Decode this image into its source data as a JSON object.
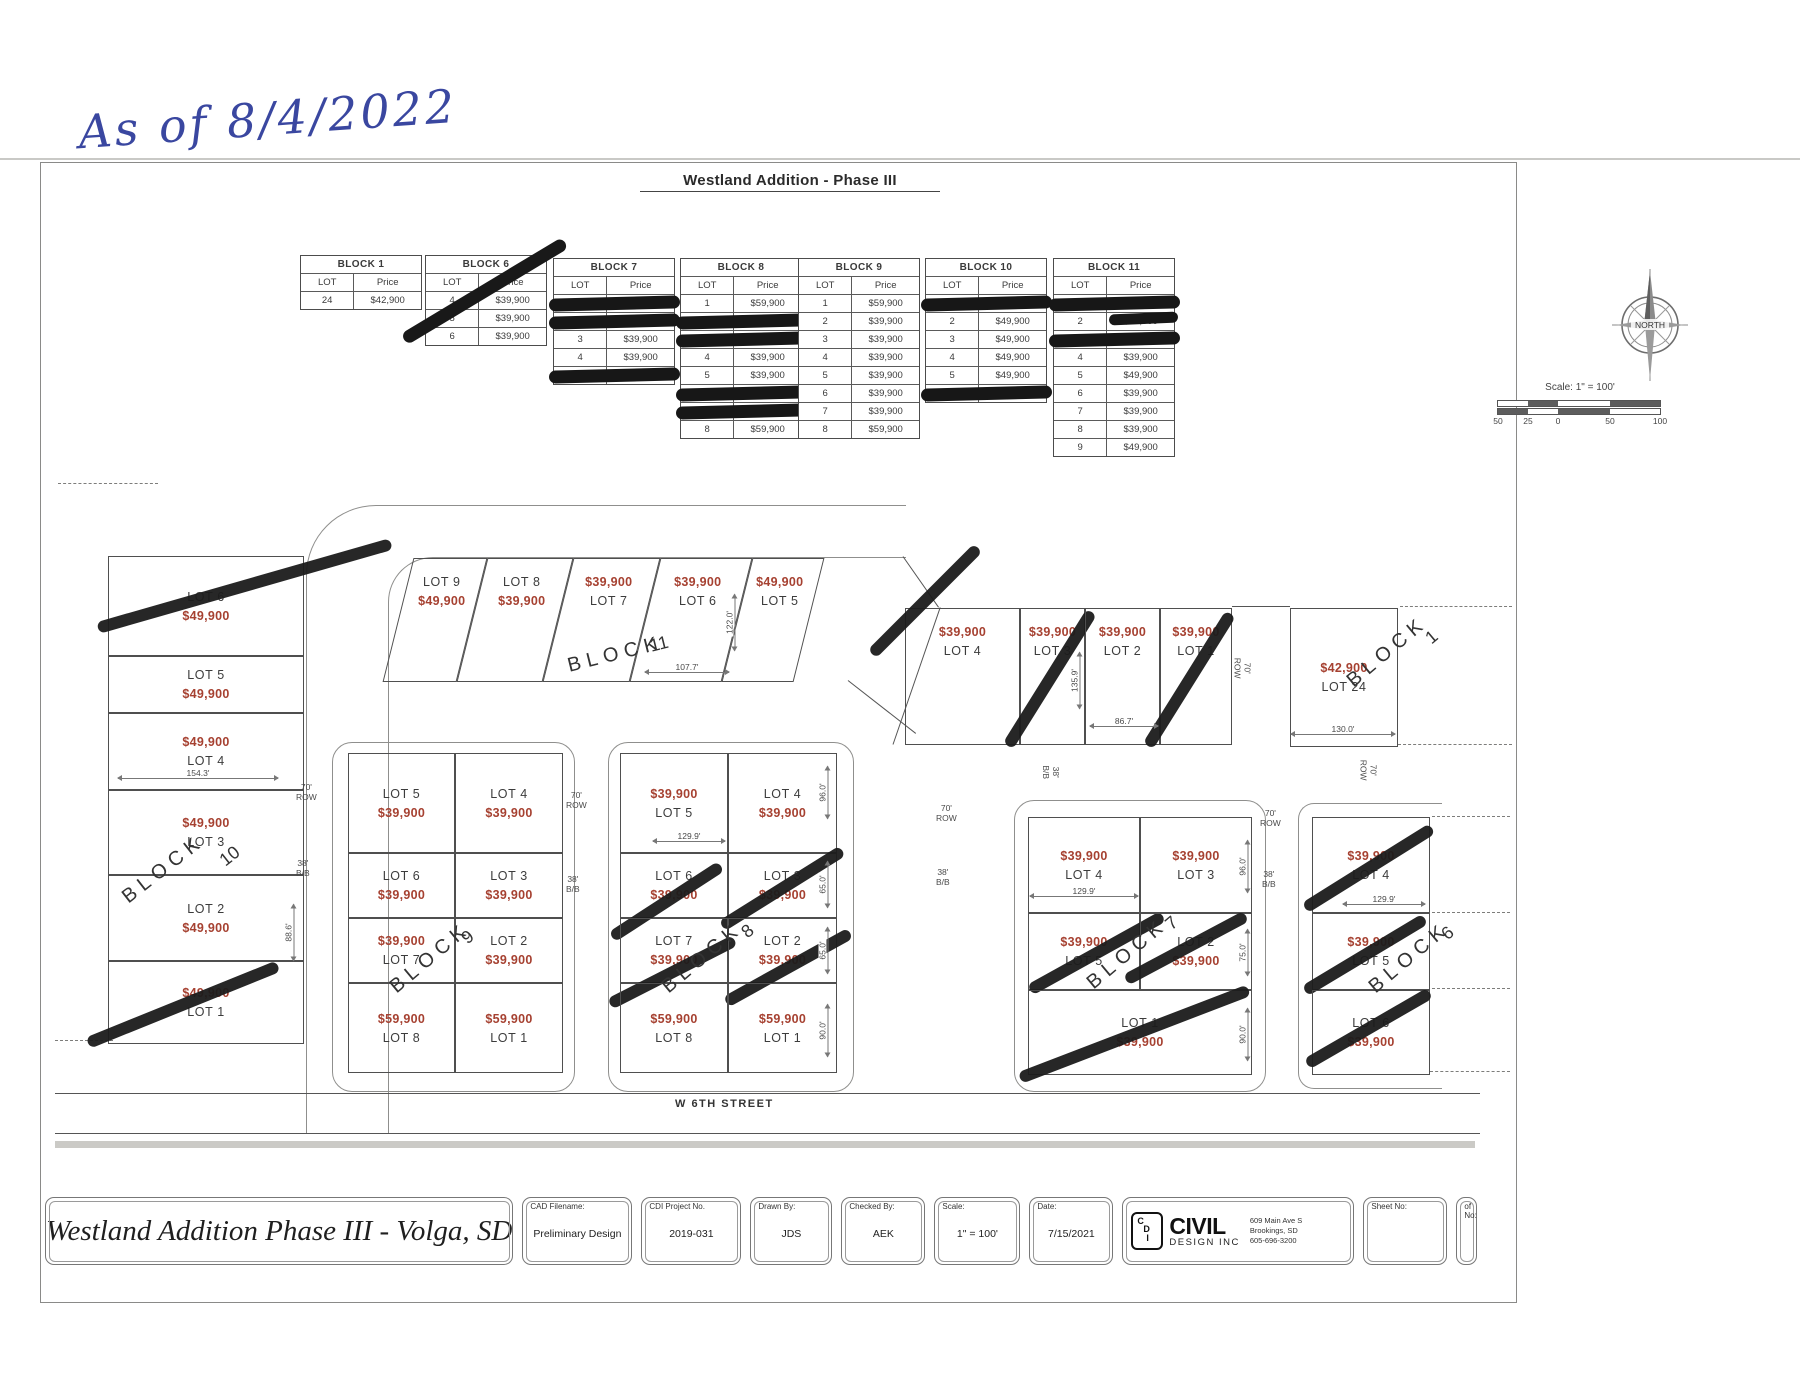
{
  "note": "As of 8/4/2022",
  "sheet_title": "Westland Addition - Phase III",
  "tables": [
    {
      "title": "BLOCK 1",
      "lot_header": "LOT",
      "price_header": "Price",
      "strike": false,
      "rows": [
        {
          "lot": "24",
          "price": "$42,900",
          "redacted": false
        }
      ]
    },
    {
      "title": "BLOCK 6",
      "lot_header": "LOT",
      "price_header": "Price",
      "strike": true,
      "rows": [
        {
          "lot": "4",
          "price": "$39,900",
          "redacted": false
        },
        {
          "lot": "5",
          "price": "$39,900",
          "redacted": false
        },
        {
          "lot": "6",
          "price": "$39,900",
          "redacted": false
        }
      ]
    },
    {
      "title": "BLOCK 7",
      "lot_header": "LOT",
      "price_header": "Price",
      "strike": false,
      "rows": [
        {
          "lot": "1",
          "price": "",
          "redacted": true
        },
        {
          "lot": "2",
          "price": "",
          "redacted": true
        },
        {
          "lot": "3",
          "price": "$39,900",
          "redacted": false
        },
        {
          "lot": "4",
          "price": "$39,900",
          "redacted": false
        },
        {
          "lot": "5",
          "price": "",
          "redacted": true
        }
      ]
    },
    {
      "title": "BLOCK 8",
      "lot_header": "LOT",
      "price_header": "Price",
      "strike": false,
      "rows": [
        {
          "lot": "1",
          "price": "$59,900",
          "redacted": false
        },
        {
          "lot": "2",
          "price": "",
          "redacted": true
        },
        {
          "lot": "3",
          "price": "",
          "redacted": true
        },
        {
          "lot": "4",
          "price": "$39,900",
          "redacted": false
        },
        {
          "lot": "5",
          "price": "$39,900",
          "redacted": false
        },
        {
          "lot": "6",
          "price": "",
          "redacted": true
        },
        {
          "lot": "7",
          "price": "",
          "redacted": true
        },
        {
          "lot": "8",
          "price": "$59,900",
          "redacted": false
        }
      ]
    },
    {
      "title": "BLOCK 9",
      "lot_header": "LOT",
      "price_header": "Price",
      "strike": false,
      "rows": [
        {
          "lot": "1",
          "price": "$59,900",
          "redacted": false
        },
        {
          "lot": "2",
          "price": "$39,900",
          "redacted": false
        },
        {
          "lot": "3",
          "price": "$39,900",
          "redacted": false
        },
        {
          "lot": "4",
          "price": "$39,900",
          "redacted": false
        },
        {
          "lot": "5",
          "price": "$39,900",
          "redacted": false
        },
        {
          "lot": "6",
          "price": "$39,900",
          "redacted": false
        },
        {
          "lot": "7",
          "price": "$39,900",
          "redacted": false
        },
        {
          "lot": "8",
          "price": "$59,900",
          "redacted": false
        }
      ]
    },
    {
      "title": "BLOCK 10",
      "lot_header": "LOT",
      "price_header": "Price",
      "strike": false,
      "rows": [
        {
          "lot": "1",
          "price": "",
          "redacted": true
        },
        {
          "lot": "2",
          "price": "$49,900",
          "redacted": false
        },
        {
          "lot": "3",
          "price": "$49,900",
          "redacted": false
        },
        {
          "lot": "4",
          "price": "$49,900",
          "redacted": false
        },
        {
          "lot": "5",
          "price": "$49,900",
          "redacted": false
        },
        {
          "lot": "6",
          "price": "",
          "redacted": true
        }
      ]
    },
    {
      "title": "BLOCK 11",
      "lot_header": "LOT",
      "price_header": "Price",
      "strike": false,
      "rows": [
        {
          "lot": "1",
          "price": "",
          "redacted": true
        },
        {
          "lot": "2",
          "price": "$39,900",
          "redacted": false,
          "partial": true
        },
        {
          "lot": "3",
          "price": "",
          "redacted": true
        },
        {
          "lot": "4",
          "price": "$39,900",
          "redacted": false
        },
        {
          "lot": "5",
          "price": "$49,900",
          "redacted": false
        },
        {
          "lot": "6",
          "price": "$39,900",
          "redacted": false
        },
        {
          "lot": "7",
          "price": "$39,900",
          "redacted": false
        },
        {
          "lot": "8",
          "price": "$39,900",
          "redacted": false
        },
        {
          "lot": "9",
          "price": "$49,900",
          "redacted": false
        }
      ]
    }
  ],
  "compass": {
    "label": "NORTH"
  },
  "scalebar": {
    "label": "Scale: 1\" = 100'",
    "ticks": [
      "50",
      "25",
      "0",
      "50",
      "100"
    ]
  },
  "map": {
    "street_label": "W 6TH STREET",
    "lots": [
      {
        "id": "b10-6",
        "label": "LOT 6",
        "price": "$49,900",
        "price_first": false,
        "crossed": true
      },
      {
        "id": "b10-5",
        "label": "LOT 5",
        "price": "$49,900",
        "price_first": false,
        "crossed": false
      },
      {
        "id": "b10-4",
        "label": "LOT 4",
        "price": "$49,900",
        "price_first": true,
        "crossed": false
      },
      {
        "id": "b10-3",
        "label": "LOT 3",
        "price": "$49,900",
        "price_first": true,
        "crossed": false
      },
      {
        "id": "b10-2",
        "label": "LOT 2",
        "price": "$49,900",
        "price_first": false,
        "crossed": false
      },
      {
        "id": "b10-1",
        "label": "LOT 1",
        "price": "$49,900",
        "price_first": true,
        "crossed": true
      },
      {
        "id": "b11-9",
        "label": "LOT 9",
        "price": "$49,900",
        "price_first": false,
        "crossed": false
      },
      {
        "id": "b11-8",
        "label": "LOT 8",
        "price": "$39,900",
        "price_first": false,
        "crossed": false
      },
      {
        "id": "b11-7",
        "label": "LOT 7",
        "price": "$39,900",
        "price_first": true,
        "crossed": false
      },
      {
        "id": "b11-6",
        "label": "LOT 6",
        "price": "$39,900",
        "price_first": true,
        "crossed": false
      },
      {
        "id": "b11-5",
        "label": "LOT 5",
        "price": "$49,900",
        "price_first": true,
        "crossed": false
      },
      {
        "id": "b11-4",
        "label": "LOT 4",
        "price": "$39,900",
        "price_first": true,
        "crossed": true
      },
      {
        "id": "b11-3",
        "label": "LOT 3",
        "price": "$39,900",
        "price_first": true,
        "crossed": true
      },
      {
        "id": "b11-2",
        "label": "LOT 2",
        "price": "$39,900",
        "price_first": true,
        "crossed": false
      },
      {
        "id": "b11-1",
        "label": "LOT 1",
        "price": "$39,900",
        "price_first": true,
        "crossed": true
      },
      {
        "id": "b1-24",
        "label": "LOT 24",
        "price": "$42,900",
        "price_first": true,
        "crossed": false
      },
      {
        "id": "b9-5",
        "label": "LOT 5",
        "price": "$39,900",
        "price_first": false,
        "crossed": false
      },
      {
        "id": "b9-4",
        "label": "LOT 4",
        "price": "$39,900",
        "price_first": false,
        "crossed": false
      },
      {
        "id": "b9-6",
        "label": "LOT 6",
        "price": "$39,900",
        "price_first": false,
        "crossed": false
      },
      {
        "id": "b9-3",
        "label": "LOT 3",
        "price": "$39,900",
        "price_first": false,
        "crossed": false
      },
      {
        "id": "b9-7",
        "label": "LOT 7",
        "price": "$39,900",
        "price_first": true,
        "crossed": false
      },
      {
        "id": "b9-2",
        "label": "LOT 2",
        "price": "$39,900",
        "price_first": false,
        "crossed": false
      },
      {
        "id": "b9-8",
        "label": "LOT 8",
        "price": "$59,900",
        "price_first": true,
        "crossed": false
      },
      {
        "id": "b9-1",
        "label": "LOT 1",
        "price": "$59,900",
        "price_first": true,
        "crossed": false
      },
      {
        "id": "b8-5",
        "label": "LOT 5",
        "price": "$39,900",
        "price_first": true,
        "crossed": false
      },
      {
        "id": "b8-4",
        "label": "LOT 4",
        "price": "$39,900",
        "price_first": false,
        "crossed": false
      },
      {
        "id": "b8-6",
        "label": "LOT 6",
        "price": "$39,900",
        "price_first": false,
        "crossed": true
      },
      {
        "id": "b8-3",
        "label": "LOT 3",
        "price": "$39,900",
        "price_first": false,
        "crossed": true
      },
      {
        "id": "b8-7",
        "label": "LOT 7",
        "price": "$39,900",
        "price_first": false,
        "crossed": true
      },
      {
        "id": "b8-2",
        "label": "LOT 2",
        "price": "$39,900",
        "price_first": false,
        "crossed": true
      },
      {
        "id": "b8-8",
        "label": "LOT 8",
        "price": "$59,900",
        "price_first": true,
        "crossed": false
      },
      {
        "id": "b8-1",
        "label": "LOT 1",
        "price": "$59,900",
        "price_first": true,
        "crossed": false
      },
      {
        "id": "b7-4",
        "label": "LOT 4",
        "price": "$39,900",
        "price_first": true,
        "crossed": false
      },
      {
        "id": "b7-3",
        "label": "LOT 3",
        "price": "$39,900",
        "price_first": true,
        "crossed": false
      },
      {
        "id": "b7-5",
        "label": "LOT 5",
        "price": "$39,900",
        "price_first": true,
        "crossed": true
      },
      {
        "id": "b7-2",
        "label": "LOT 2",
        "price": "$39,900",
        "price_first": false,
        "crossed": true
      },
      {
        "id": "b7-1",
        "label": "LOT 1",
        "price": "$39,900",
        "price_first": false,
        "crossed": true
      },
      {
        "id": "b6-4",
        "label": "LOT 4",
        "price": "$39,900",
        "price_first": true,
        "crossed": true
      },
      {
        "id": "b6-5",
        "label": "LOT 5",
        "price": "$39,900",
        "price_first": true,
        "crossed": true
      },
      {
        "id": "b6-6",
        "label": "LOT 6",
        "price": "$39,900",
        "price_first": false,
        "crossed": true
      }
    ],
    "block_labels": [
      {
        "word": "BLOCK",
        "num": "10"
      },
      {
        "word": "BLOCK",
        "num": "11"
      },
      {
        "word": "BLOCK",
        "num": "1"
      },
      {
        "word": "BLOCK",
        "num": "9"
      },
      {
        "word": "BLOCK",
        "num": "8"
      },
      {
        "word": "BLOCK",
        "num": "7"
      },
      {
        "word": "BLOCK",
        "num": "6"
      }
    ],
    "dims": [
      "154.3'",
      "107.7'",
      "86.7'",
      "130.0'",
      "129.9'",
      "129.9'",
      "129.9'",
      "88.6'",
      "135.9'",
      "122.0'",
      "96.0'",
      "65.0'",
      "65.0'",
      "90.0'",
      "96.0'",
      "75.0'",
      "90.0'"
    ],
    "road_labels": [
      {
        "line1": "70'",
        "line2": "ROW"
      },
      {
        "line1": "38'",
        "line2": "B/B"
      },
      {
        "line1": "70'",
        "line2": "ROW"
      },
      {
        "line1": "38'",
        "line2": "B/B"
      },
      {
        "line1": "70'",
        "line2": "ROW"
      },
      {
        "line1": "38'",
        "line2": "B/B"
      },
      {
        "line1": "70'",
        "line2": "ROW"
      },
      {
        "line1": "38'",
        "line2": "B/B"
      },
      {
        "line1": "38'",
        "line2": "B/B"
      },
      {
        "line1": "70'",
        "line2": "ROW"
      },
      {
        "line1": "70'",
        "line2": "ROW"
      }
    ]
  },
  "titleblock": {
    "drawing_title": "Westland Addition Phase III - Volga, SD",
    "fields": [
      {
        "label": "CAD Filename:",
        "value": "Preliminary Design"
      },
      {
        "label": "CDI Project No.",
        "value": "2019-031"
      },
      {
        "label": "Drawn By:",
        "value": "JDS"
      },
      {
        "label": "Checked By:",
        "value": "AEK"
      },
      {
        "label": "Scale:",
        "value": "1\" = 100'"
      },
      {
        "label": "Date:",
        "value": "7/15/2021"
      }
    ],
    "company": {
      "initials": [
        "C",
        "D",
        "I"
      ],
      "name": "CIVIL",
      "sub": "DESIGN INC",
      "address1": "609 Main Ave S",
      "address2": "Brookings, SD",
      "phone": "605-696-3200"
    },
    "sheet_label": "Sheet No:",
    "of_label": "of No:"
  }
}
